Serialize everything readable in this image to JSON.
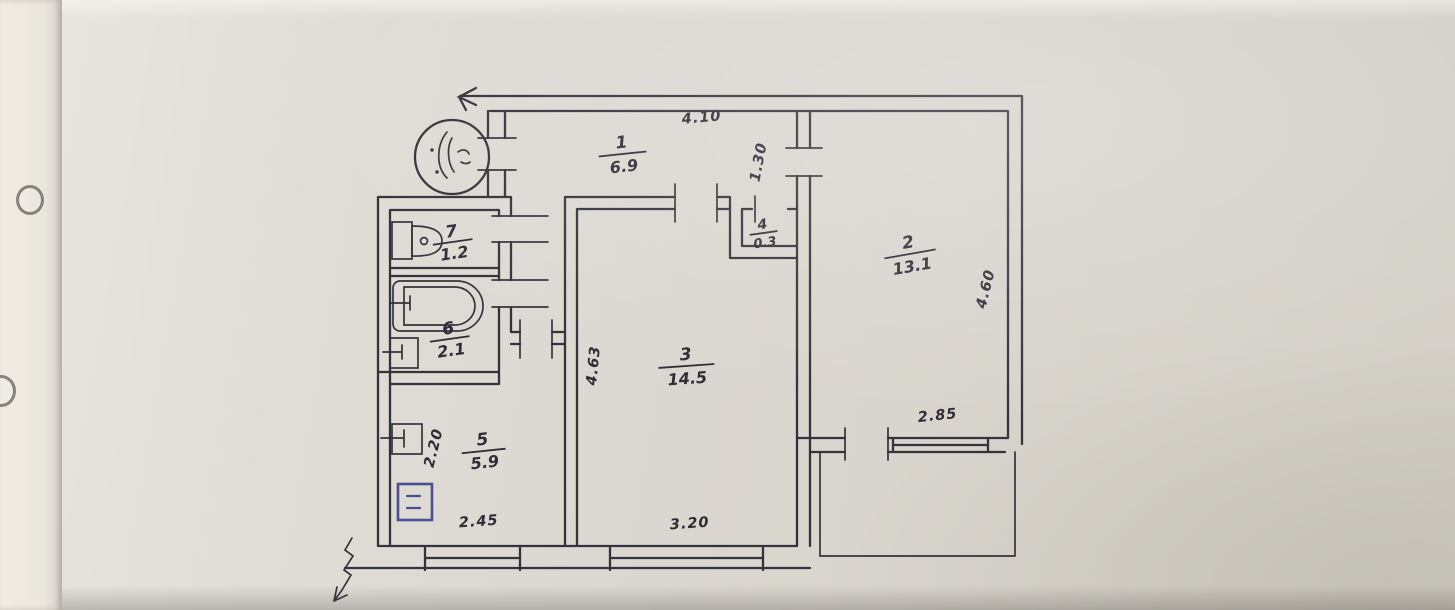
{
  "floor_plan": {
    "rooms": [
      {
        "number": "1",
        "area": "6.9"
      },
      {
        "number": "2",
        "area": "13.1"
      },
      {
        "number": "3",
        "area": "14.5"
      },
      {
        "number": "4",
        "area": "0.3"
      },
      {
        "number": "5",
        "area": "5.9"
      },
      {
        "number": "6",
        "area": "2.1"
      },
      {
        "number": "7",
        "area": "1.2"
      }
    ],
    "dimensions": {
      "hall_top": "4.10",
      "hall_opening": "1.30",
      "room2_right": "4.60",
      "room2_bottom": "2.85",
      "room3_left": "4.63",
      "room3_bottom": "3.20",
      "kitchen_bottom": "2.45",
      "kitchen_left": "2.20"
    },
    "colors": {
      "ink": "#34333b",
      "paper": "#dad7d0",
      "stove_blue": "#4a4f93"
    }
  }
}
